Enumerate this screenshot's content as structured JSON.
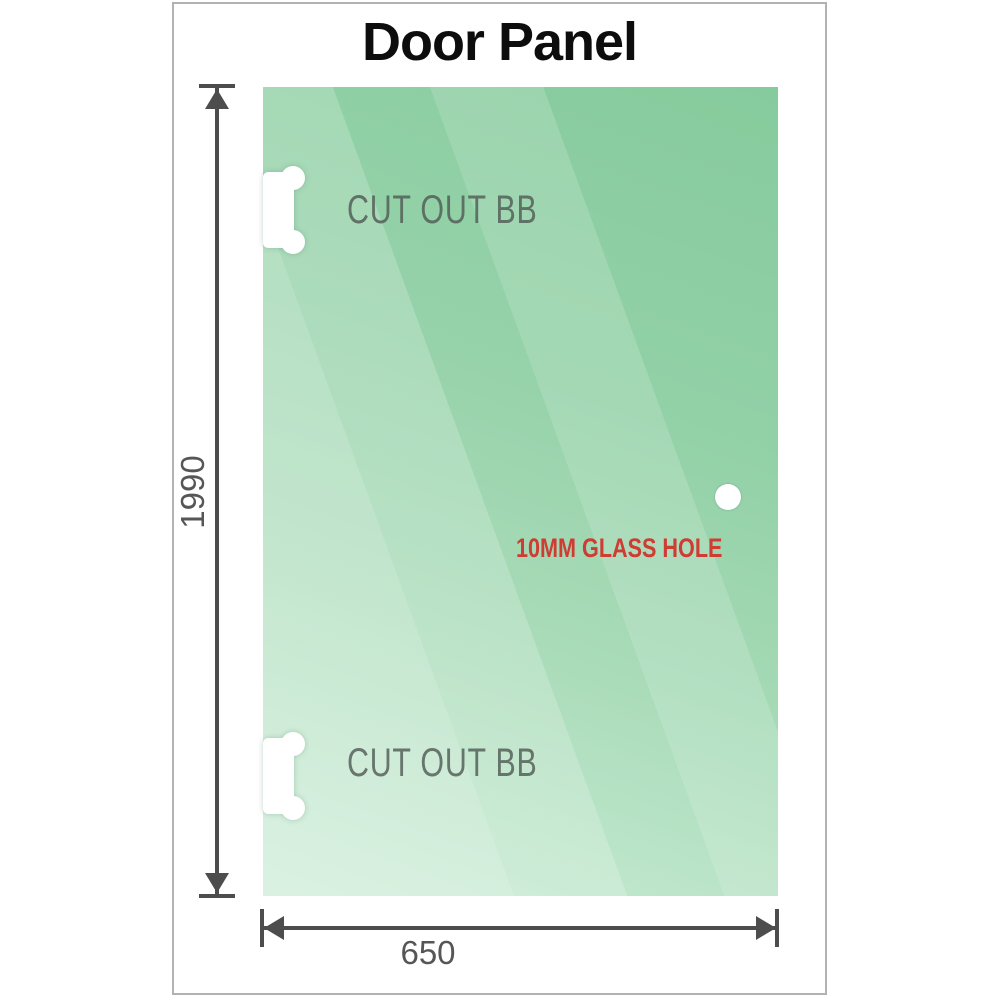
{
  "title": "Door Panel",
  "glass_panel": {
    "fill_base_color": "#8ecfa4",
    "fill_light_color": "#c9ebd4",
    "cutout_label": "CUT OUT BB",
    "cutout_count": 2,
    "hole": {
      "label": "10MM GLASS HOLE",
      "label_color": "#ce3c33",
      "shape": "circle"
    }
  },
  "dimensions": {
    "height": {
      "label": "1990",
      "orientation": "vertical"
    },
    "width": {
      "label": "650",
      "orientation": "horizontal"
    },
    "line_color": "#4d4d4d",
    "label_color": "#565656"
  },
  "frame_border_color": "#b2b2b2"
}
